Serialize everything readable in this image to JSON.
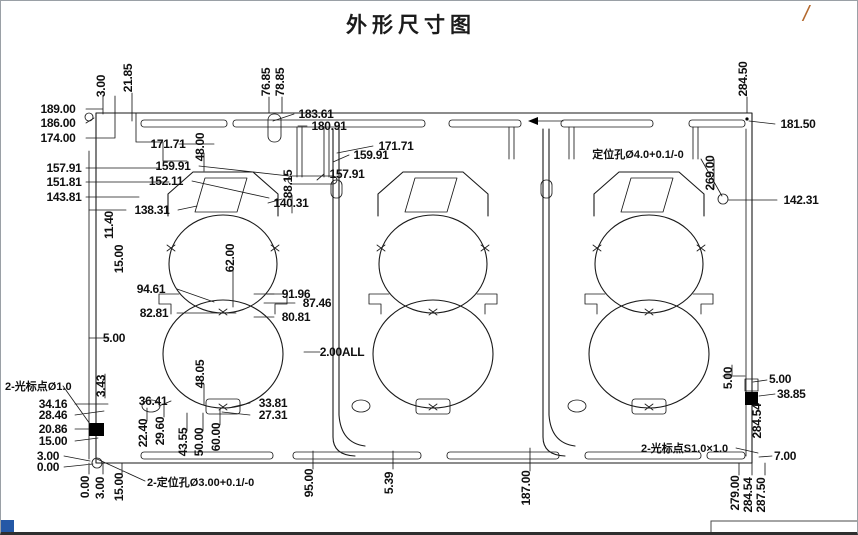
{
  "page": {
    "title": "外形尺寸图",
    "rev_mark": "/"
  },
  "colors": {
    "ink": "#1a1a1a",
    "label": "#101010",
    "fiducial": "#000000",
    "accent_blue": "#2458a6",
    "rev_mark": "#b4692e"
  },
  "drawing": {
    "notes": [
      "定位孔Ø4.0+0.1/-0",
      "2-定位孔Ø3.00+0.1/-0",
      "2-光标点Ø1.0",
      "2-光标点S1.0×1.0",
      "2.00ALL"
    ],
    "annotations": [
      {
        "t": "189.00",
        "x": 57,
        "y": 112
      },
      {
        "t": "186.00",
        "x": 57,
        "y": 126
      },
      {
        "t": "174.00",
        "x": 57,
        "y": 141
      },
      {
        "t": "157.91",
        "x": 63,
        "y": 171
      },
      {
        "t": "151.81",
        "x": 63,
        "y": 185
      },
      {
        "t": "143.81",
        "x": 63,
        "y": 200
      },
      {
        "t": "138.31",
        "x": 151,
        "y": 213
      },
      {
        "t": "152.11",
        "x": 165,
        "y": 184
      },
      {
        "t": "159.91",
        "x": 172,
        "y": 169
      },
      {
        "t": "171.71",
        "x": 167,
        "y": 147
      },
      {
        "t": "48.00",
        "x": 203,
        "y": 146,
        "r": -90
      },
      {
        "t": "183.61",
        "x": 315,
        "y": 117
      },
      {
        "t": "180.91",
        "x": 328,
        "y": 129
      },
      {
        "t": "171.71",
        "x": 395,
        "y": 149
      },
      {
        "t": "159.91",
        "x": 370,
        "y": 158
      },
      {
        "t": "157.91",
        "x": 346,
        "y": 177
      },
      {
        "t": "88.15",
        "x": 291,
        "y": 183,
        "r": -90
      },
      {
        "t": "140.31",
        "x": 290,
        "y": 206
      },
      {
        "t": "3.00",
        "x": 104,
        "y": 85,
        "r": -90
      },
      {
        "t": "21.85",
        "x": 131,
        "y": 77,
        "r": -90
      },
      {
        "t": "76.85",
        "x": 269,
        "y": 81,
        "r": -90
      },
      {
        "t": "78.85",
        "x": 283,
        "y": 81,
        "r": -90
      },
      {
        "t": "284.50",
        "x": 746,
        "y": 78,
        "r": -90
      },
      {
        "t": "181.50",
        "x": 797,
        "y": 127
      },
      {
        "t": "定位孔Ø4.0+0.1/-0",
        "x": 637,
        "y": 157,
        "cls": "note"
      },
      {
        "t": "269.00",
        "x": 713,
        "y": 172,
        "r": -90
      },
      {
        "t": "142.31",
        "x": 800,
        "y": 203
      },
      {
        "t": "11.40",
        "x": 112,
        "y": 224,
        "r": -90
      },
      {
        "t": "15.00",
        "x": 122,
        "y": 258,
        "r": -90
      },
      {
        "t": "62.00",
        "x": 233,
        "y": 257,
        "r": -90
      },
      {
        "t": "94.61",
        "x": 150,
        "y": 292
      },
      {
        "t": "91.96",
        "x": 295,
        "y": 297
      },
      {
        "t": "87.46",
        "x": 316,
        "y": 306
      },
      {
        "t": "82.81",
        "x": 153,
        "y": 316
      },
      {
        "t": "80.81",
        "x": 295,
        "y": 320
      },
      {
        "t": "5.00",
        "x": 113,
        "y": 341
      },
      {
        "t": "2.00ALL",
        "x": 341,
        "y": 355
      },
      {
        "t": "48.05",
        "x": 203,
        "y": 373,
        "r": -90
      },
      {
        "t": "3.43",
        "x": 104,
        "y": 385,
        "r": -90
      },
      {
        "t": "2-光标点Ø1.0",
        "x": 4,
        "y": 389,
        "a": "s",
        "cls": "note"
      },
      {
        "t": "34.16",
        "x": 52,
        "y": 407
      },
      {
        "t": "28.46",
        "x": 52,
        "y": 418
      },
      {
        "t": "20.86",
        "x": 52,
        "y": 432
      },
      {
        "t": "15.00",
        "x": 52,
        "y": 444
      },
      {
        "t": "3.00",
        "x": 47,
        "y": 459
      },
      {
        "t": "0.00",
        "x": 47,
        "y": 470
      },
      {
        "t": "36.41",
        "x": 152,
        "y": 404
      },
      {
        "t": "33.81",
        "x": 272,
        "y": 406
      },
      {
        "t": "27.31",
        "x": 272,
        "y": 418
      },
      {
        "t": "22.40",
        "x": 146,
        "y": 432,
        "r": -90
      },
      {
        "t": "29.60",
        "x": 163,
        "y": 430,
        "r": -90
      },
      {
        "t": "43.55",
        "x": 186,
        "y": 441,
        "r": -90
      },
      {
        "t": "50.00",
        "x": 202,
        "y": 441,
        "r": -90
      },
      {
        "t": "60.00",
        "x": 219,
        "y": 436,
        "r": -90
      },
      {
        "t": "2-定位孔Ø3.00+0.1/-0",
        "x": 146,
        "y": 485,
        "a": "s",
        "cls": "note"
      },
      {
        "t": "0.00",
        "x": 88,
        "y": 486,
        "r": -90
      },
      {
        "t": "3.00",
        "x": 103,
        "y": 487,
        "r": -90
      },
      {
        "t": "15.00",
        "x": 122,
        "y": 486,
        "r": -90
      },
      {
        "t": "95.00",
        "x": 312,
        "y": 482,
        "r": -90
      },
      {
        "t": "5.39",
        "x": 392,
        "y": 482,
        "r": -90
      },
      {
        "t": "187.00",
        "x": 529,
        "y": 487,
        "r": -90
      },
      {
        "t": "5.00",
        "x": 731,
        "y": 377,
        "r": -90
      },
      {
        "t": "5.00",
        "x": 768,
        "y": 382,
        "a": "s"
      },
      {
        "t": "38.85",
        "x": 776,
        "y": 397,
        "a": "s"
      },
      {
        "t": "284.54",
        "x": 760,
        "y": 420,
        "r": -90
      },
      {
        "t": "2-光标点S1.0×1.0",
        "x": 640,
        "y": 451,
        "a": "s",
        "cls": "note"
      },
      {
        "t": "7.00",
        "x": 773,
        "y": 459,
        "a": "s"
      },
      {
        "t": "279.00",
        "x": 738,
        "y": 492,
        "r": -90
      },
      {
        "t": "284.54",
        "x": 751,
        "y": 494,
        "r": -90
      },
      {
        "t": "287.50",
        "x": 764,
        "y": 494,
        "r": -90
      }
    ]
  }
}
